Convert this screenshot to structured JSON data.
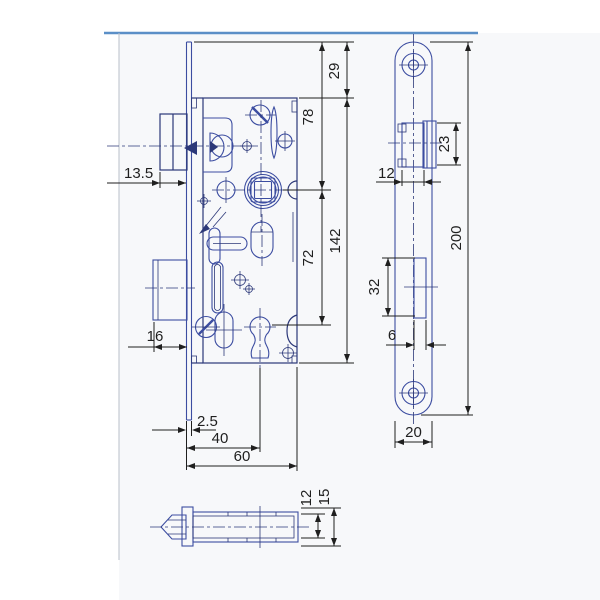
{
  "colors": {
    "bg": "#ffffff",
    "panel": "#f7f8fa",
    "frame": "#5b8fc7",
    "faint": "#b9bfc9",
    "line": "#3c4da1",
    "line2": "#2c3879",
    "dim": "#1f1f1f"
  },
  "views": {
    "front": {
      "label": "lock case side view",
      "dims": {
        "latch_protrusion": "13.5",
        "deadbolt_protrusion": "16",
        "plate_thickness": "2.5",
        "backset": "40",
        "case_depth": "60",
        "plate_top_to_case": "29",
        "plate_top_to_follower": "78",
        "follower_to_key": "72",
        "case_height": "142"
      }
    },
    "faceplate": {
      "label": "faceplate front view",
      "dims": {
        "latch_width": "12",
        "latch_height": "23",
        "bolt_slot_height": "32",
        "bolt_slot_width": "6",
        "plate_length": "200",
        "plate_width": "20"
      }
    },
    "bottom": {
      "label": "bottom section view",
      "dims": {
        "case_thickness": "12",
        "plate_height": "15"
      }
    }
  }
}
